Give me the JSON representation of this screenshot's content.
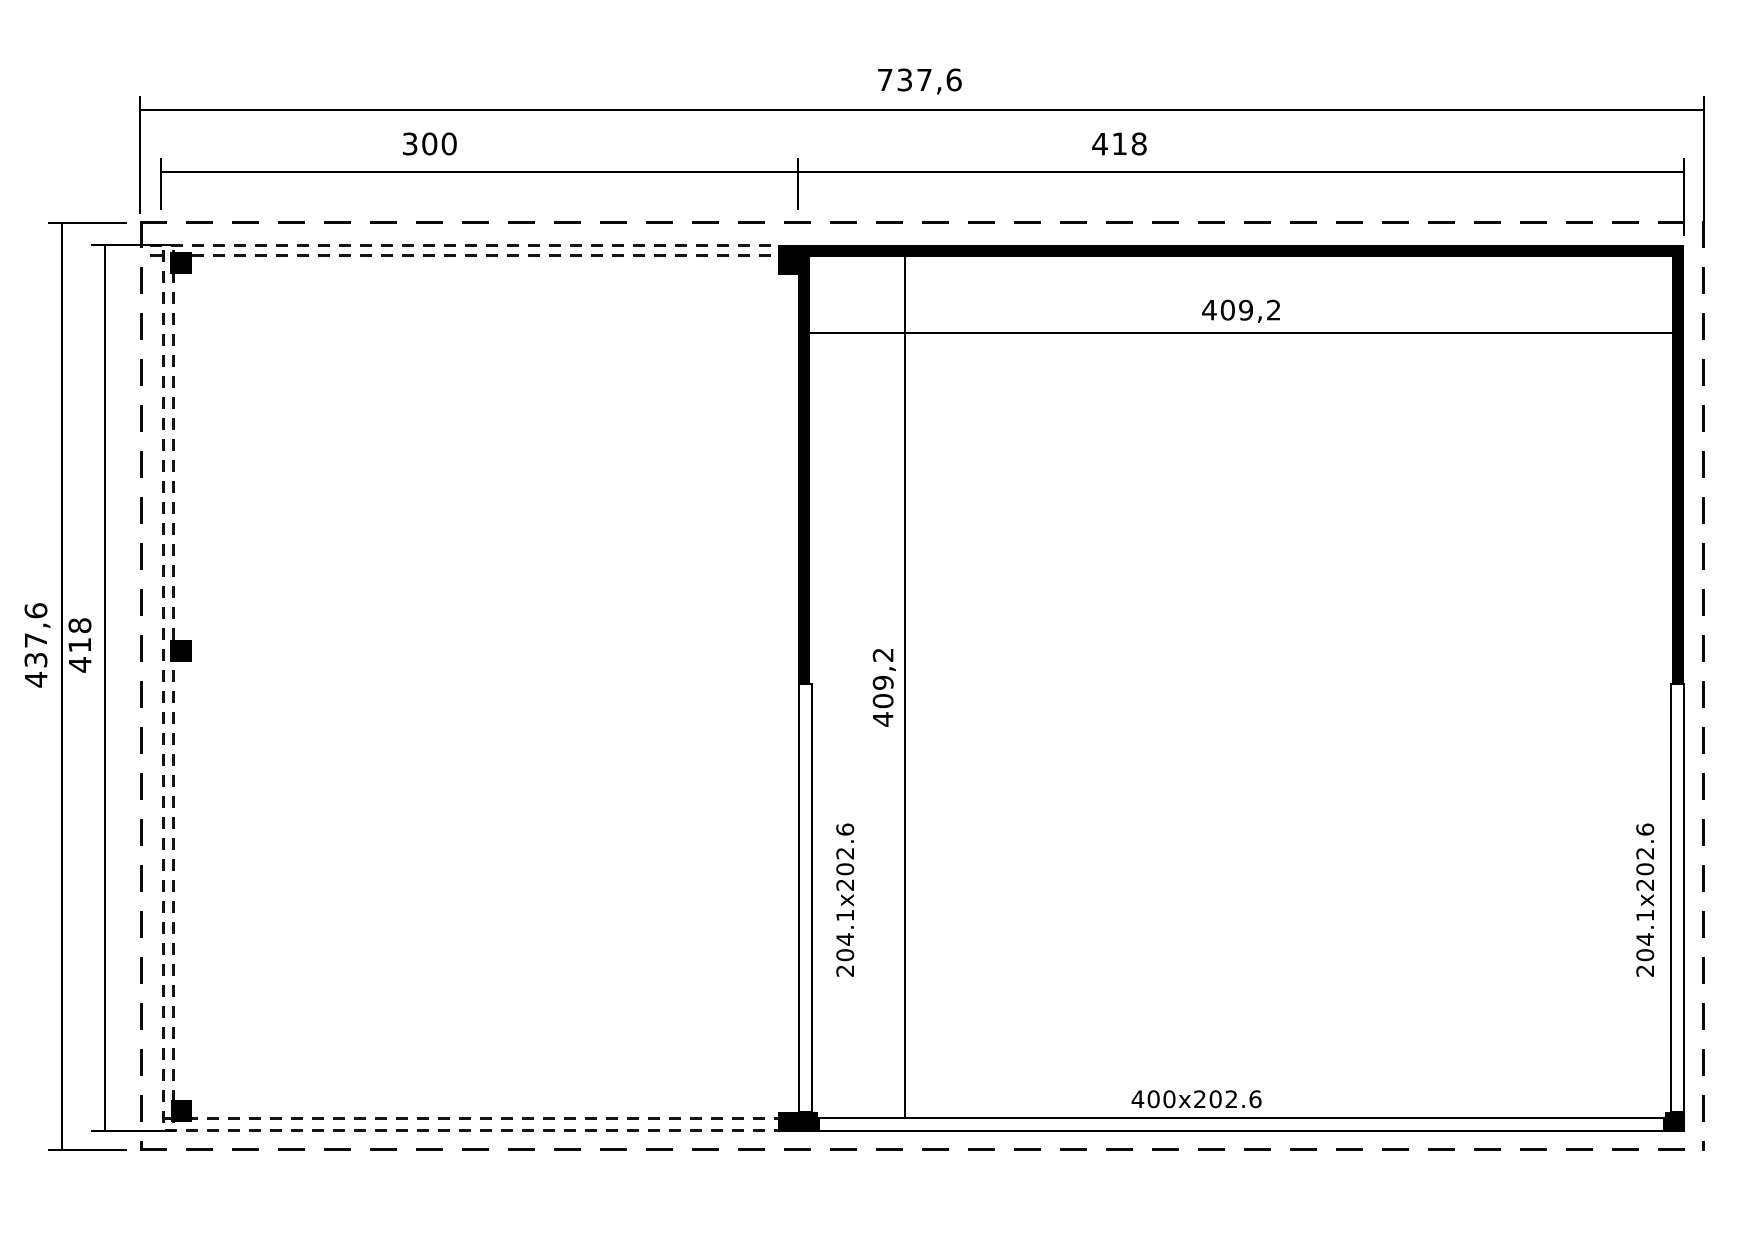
{
  "drawing": {
    "type": "floor-plan",
    "background_color": "#ffffff",
    "line_color": "#000000"
  },
  "dimensions": {
    "overall_width": "737,6",
    "carport_width": "300",
    "room_width": "418",
    "overall_depth": "437,6",
    "building_depth": "418",
    "room_inner_width": "409,2",
    "room_inner_depth": "409,2"
  },
  "openings": {
    "left_door": "204.1x202.6",
    "right_door": "204.1x202.6",
    "rear_opening": "400x202.6"
  }
}
